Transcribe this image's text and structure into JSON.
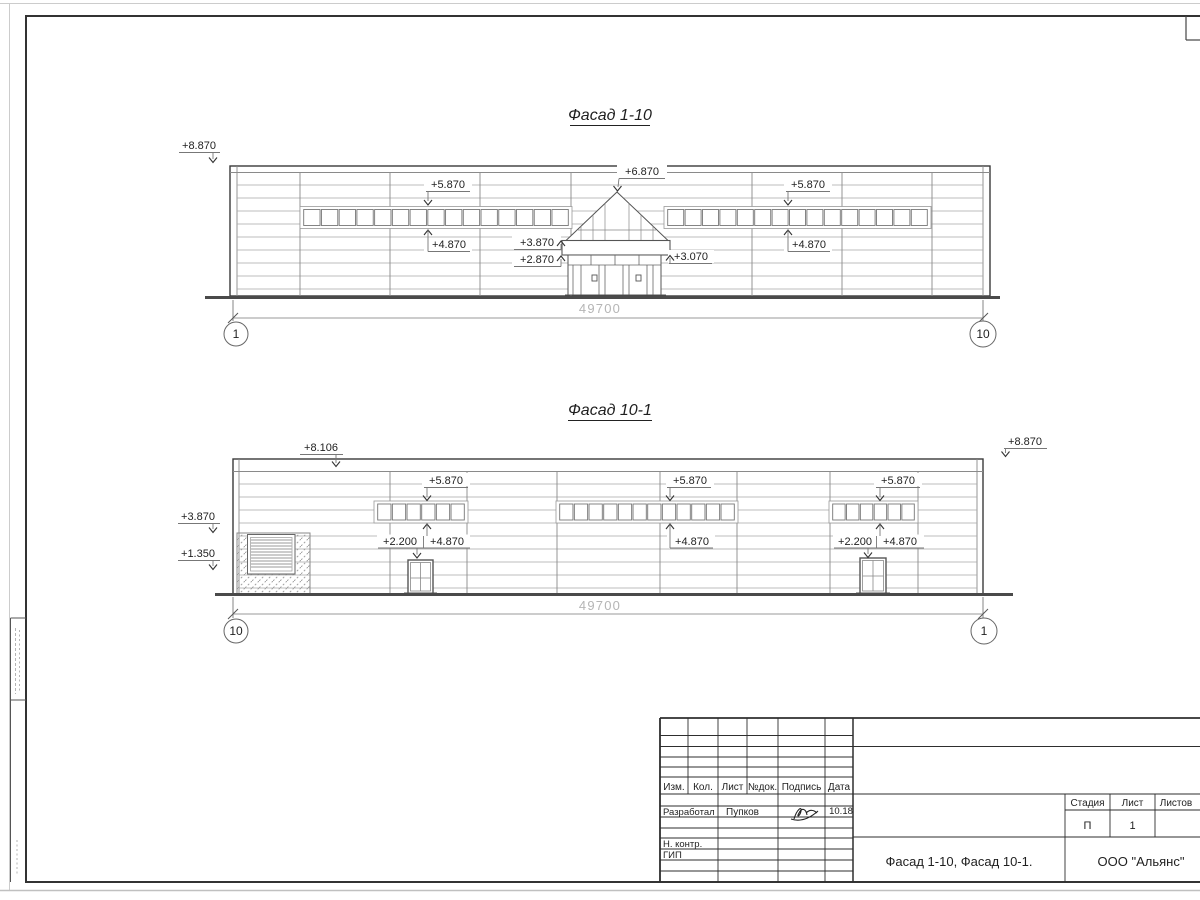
{
  "facade1": {
    "title": "Фасад 1-10",
    "dimension_mm": "49700",
    "axis_left": "1",
    "axis_right": "10",
    "marks": {
      "roof_left": "+8.870",
      "band_left_top": "+5.870",
      "band_left_bottom": "+4.870",
      "entrance_peak": "+6.870",
      "canopy_top": "+3.870",
      "canopy_bottom": "+2.870",
      "canopy_right": "+3.070",
      "band_right_top": "+5.870",
      "band_right_bottom": "+4.870"
    }
  },
  "facade2": {
    "title": "Фасад 10-1",
    "dimension_mm": "49700",
    "axis_left": "10",
    "axis_right": "1",
    "marks": {
      "parapet_left": "+8.106",
      "roof_right": "+8.870",
      "wall_left_upper": "+3.870",
      "wall_left_lower": "+1.350",
      "band_a_top": "+5.870",
      "band_a_bottom": "+4.870",
      "door_a": "+2.200",
      "band_b_top": "+5.870",
      "band_b_bottom": "+4.870",
      "band_c_top": "+5.870",
      "band_c_bottom": "+4.870",
      "door_c": "+2.200"
    }
  },
  "title_block": {
    "columns": [
      "Изм.",
      "Кол.",
      "Лист",
      "№док.",
      "Подпись",
      "Дата"
    ],
    "developer_role": "Разработал",
    "developer_name": "Пупков",
    "signature_date": "10.18",
    "normcontrol_role": "Н. контр.",
    "chief_engineer_role": "ГИП",
    "stage_label": "Стадия",
    "sheet_label": "Лист",
    "sheets_label": "Листов",
    "stage": "П",
    "sheet_number": "1",
    "drawing_title": "Фасад 1-10, Фасад 10-1.",
    "company": "ООО \"Альянс\""
  },
  "colors": {
    "ink": "#2e2e2e",
    "thin_line": "#a8a8a8",
    "dim_text": "#b5b5b5"
  }
}
